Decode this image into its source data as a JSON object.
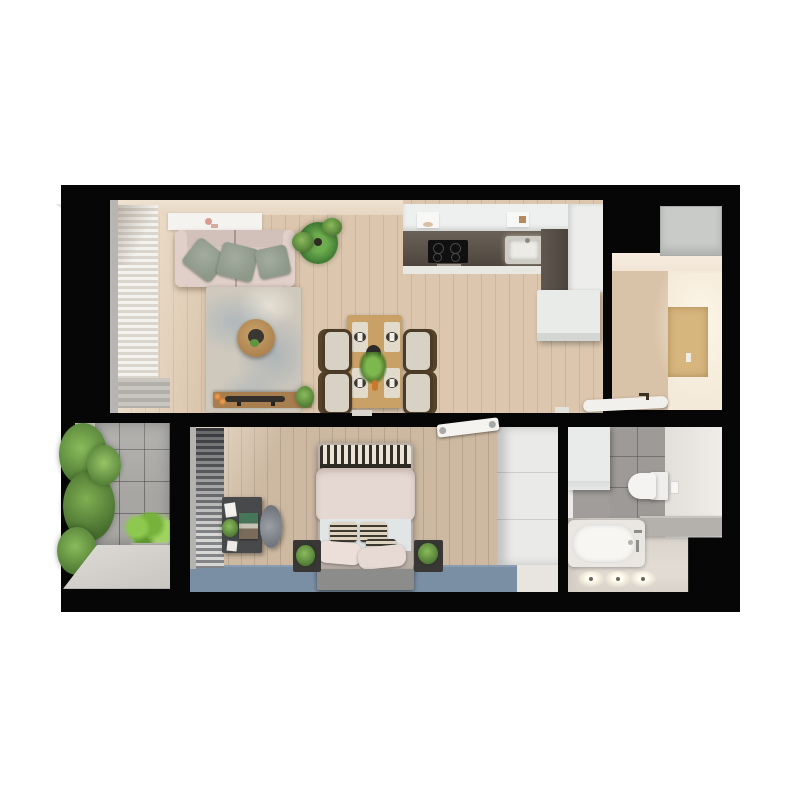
{
  "scene": {
    "type": "3d-floor-plan-top-view-render",
    "description_items": [
      "apartment-floor-plan",
      "top-down-3d-render",
      "no-visible-text"
    ]
  },
  "palette": {
    "page_bg": "#ffffff",
    "wall": "#060606",
    "floor_wood_living": "#dcc7ae",
    "floor_wood_bedroom": "#cdb9a2",
    "floor_cream_hall": "#f4ead9",
    "rug_living": "#cfc9bd",
    "rug_bedroom_blue": "#7b8fa4",
    "kitchen_cabinet_white": "#eef0ef",
    "kitchen_counter_dark": "#57504a",
    "peninsula_white": "#e9ebe9",
    "sofa_beige": "#d9c8c1",
    "pillow_sage": "#98a295",
    "table_wood": "#c9a066",
    "console_wood": "#a87e4f",
    "chair_wood_dark": "#4c3b27",
    "plant_green": "#5f9440",
    "balcony_tile_gray": "#a7a6a3",
    "balcony_slab": "#d6d3cf",
    "bath_tile_gray": "#9d9a97",
    "bath_floor": "#d6d0c9",
    "fixture_white": "#f4f3f1",
    "duvet_pink": "#e5d8d3",
    "bed_bench_gray": "#8c8c8a",
    "wardrobe_white": "#eaeae8",
    "hall_cabinet_gray": "#c9cbc9",
    "entry_panel_wood": "#d7b67e",
    "desk_dark": "#47494b",
    "blinds_gray": "#55565a",
    "curtain_white": "#efece7",
    "candle_orange": "#d4813c"
  },
  "rooms": {
    "living_room": {
      "label": "living room",
      "items": [
        "ceiling-light-panel",
        "sofa",
        "throw-pillows-x3",
        "potted-plant",
        "area-rug",
        "round-coffee-table",
        "media-console",
        "candles-x2",
        "decor-tray",
        "sheer-curtains",
        "window-bench"
      ]
    },
    "dining_area": {
      "label": "dining area",
      "items": [
        "dining-table",
        "dining-chairs-x4",
        "place-settings-x4",
        "centerpiece-plant",
        "dark-vase"
      ]
    },
    "kitchen": {
      "label": "kitchen",
      "items": [
        "upper-cabinets",
        "range-hood",
        "cooktop-4-burner",
        "sink",
        "l-shaped-dark-counter",
        "peninsula-cabinet"
      ]
    },
    "hallway": {
      "label": "entry hall",
      "items": [
        "tall-gray-cabinet",
        "wooden-wall-panel",
        "entry-door-open"
      ]
    },
    "bedroom": {
      "label": "bedroom",
      "items": [
        "window-blinds",
        "desk",
        "desk-chair",
        "desk-plant",
        "double-bed",
        "patterned-throw",
        "duvet",
        "pillows-x6",
        "bed-bench",
        "nightstands-x2",
        "nightstand-plants-x2",
        "blue-rug",
        "wardrobe",
        "ceiling-light-bar"
      ]
    },
    "bathroom": {
      "label": "bathroom",
      "items": [
        "storage-cabinet",
        "gray-wall-tiles",
        "wall-hung-toilet",
        "shelf-ledge",
        "bathtub",
        "faucet",
        "floor-spotlights-x3"
      ]
    },
    "balcony": {
      "label": "balcony",
      "items": [
        "hedge-plants",
        "planter-box",
        "stone-tiles",
        "concrete-slab"
      ]
    }
  }
}
